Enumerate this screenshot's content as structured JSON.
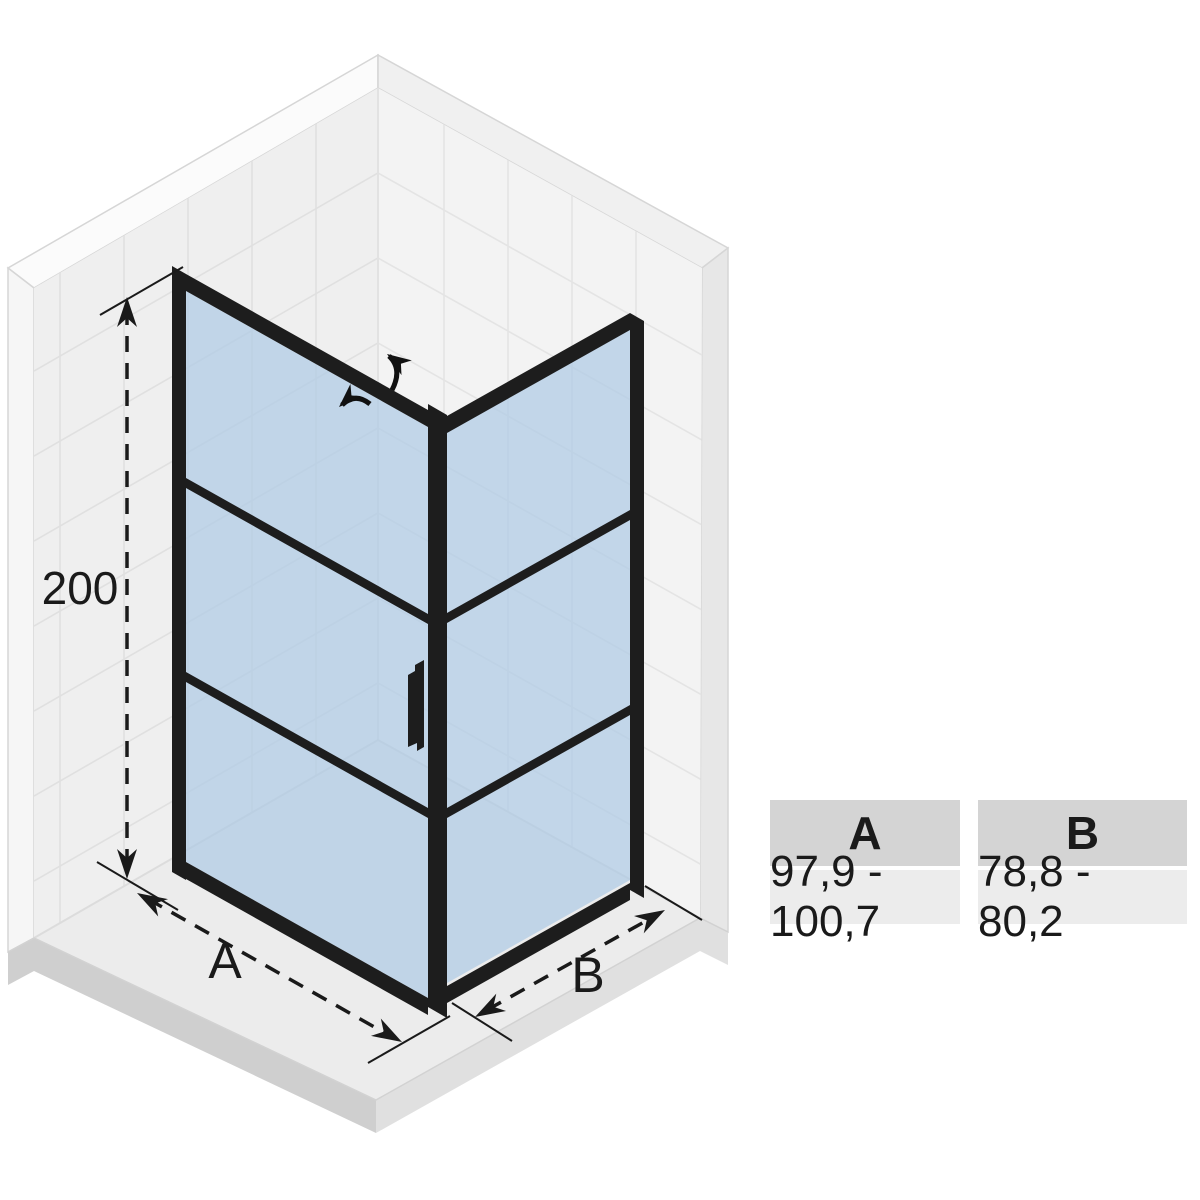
{
  "dimensions": {
    "height": {
      "label": "200"
    },
    "width_a": {
      "label": "A"
    },
    "width_b": {
      "label": "B"
    }
  },
  "table": {
    "columns": [
      {
        "header": "A",
        "value": "97,9 - 100,7"
      },
      {
        "header": "B",
        "value": "78,8 - 80,2"
      }
    ]
  },
  "colors": {
    "frame": "#1d1d1d",
    "glass": "#aecbe4",
    "left_wall": "#efefef",
    "right_wall": "#f3f3f3",
    "floor": "#ececec",
    "table_header_bg": "#d4d4d4",
    "table_value_bg": "#ececec"
  },
  "icons": [
    "door-swing-arrow-open",
    "door-swing-arrow-close"
  ]
}
